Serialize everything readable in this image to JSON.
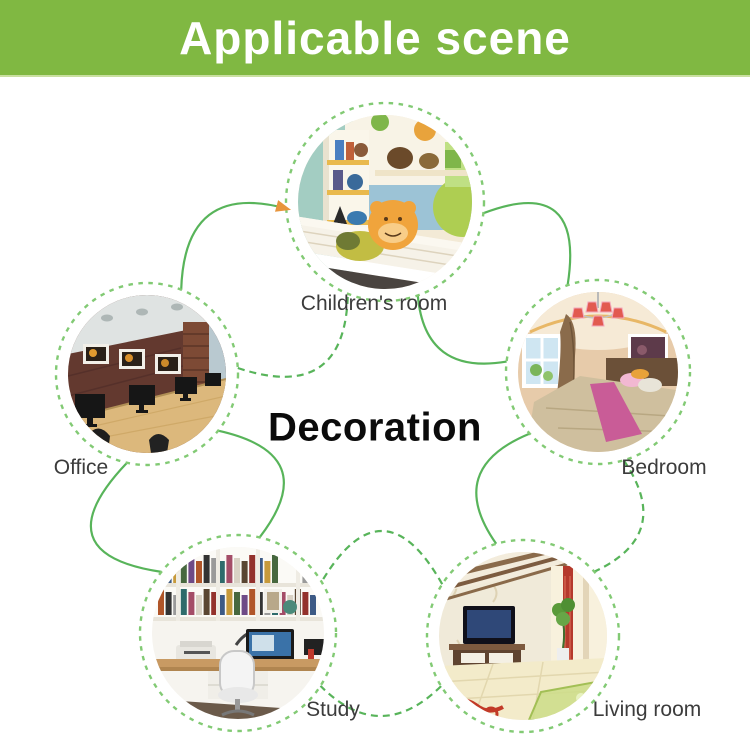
{
  "header": {
    "title": "Applicable scene"
  },
  "diagram": {
    "center_label": "Decoration",
    "scenes": [
      {
        "id": "children-room",
        "label": "Children's room"
      },
      {
        "id": "office",
        "label": "Office"
      },
      {
        "id": "bedroom",
        "label": "Bedroom"
      },
      {
        "id": "study",
        "label": "Study"
      },
      {
        "id": "living-room",
        "label": "Living room"
      }
    ]
  },
  "colors": {
    "banner_green": "#80b842",
    "line_green": "#58b45a",
    "ring_green": "#82ca74",
    "arrow_orange": "#e8953c",
    "label_gray": "#3c3c3c",
    "title_white": "#ffffff"
  }
}
